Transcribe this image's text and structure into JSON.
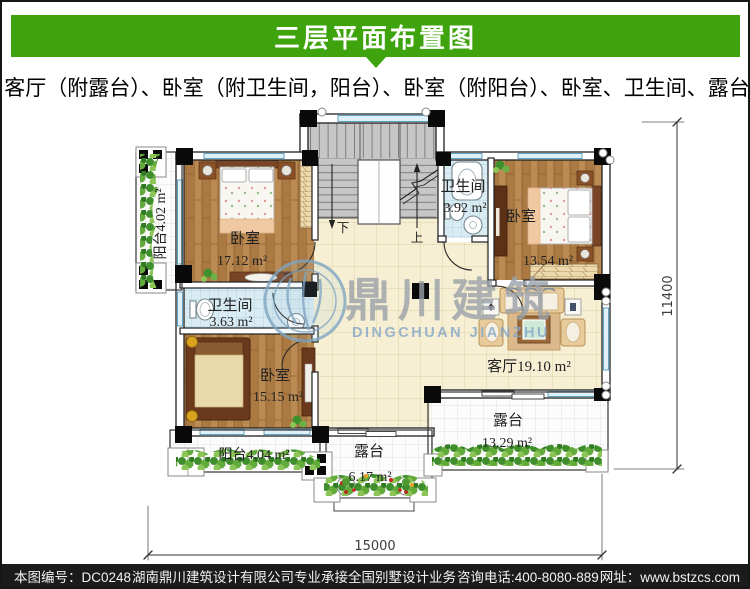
{
  "header": {
    "title": "三层平面布置图",
    "bg_color": "#3ea30d",
    "text_color": "#ffffff"
  },
  "subtitle": "客厅（附露台）、卧室（附卫生间，阳台）、卧室（附阳台）、卧室、卫生间、露台",
  "plan": {
    "rooms": {
      "bedroom_top_left": {
        "name": "卧室",
        "area": "17.12 m²"
      },
      "bathroom_left": {
        "name": "卫生间",
        "area": "3.63 m²"
      },
      "bedroom_bottom_left": {
        "name": "卧室",
        "area": "15.15 m²"
      },
      "bedroom_top_right": {
        "name": "卧室",
        "area": "13.54 m²"
      },
      "bathroom_right": {
        "name": "卫生间",
        "area": "3.92 m²"
      },
      "living_room": {
        "label": "客厅19.10 m²"
      },
      "balcony_left": {
        "label": "阳台4.02 m²"
      },
      "balcony_bottom": {
        "label": "阳台4.04 m²"
      },
      "terrace_bottom": {
        "name": "露台",
        "area": "6.17 m²"
      },
      "terrace_right": {
        "name": "露台",
        "area": "13.29 m²"
      }
    },
    "stairs": {
      "down": "下",
      "up": "上"
    },
    "dimensions": {
      "bottom": "15000",
      "right": "11400"
    }
  },
  "watermark": {
    "cn": "鼎川建筑",
    "en": "DINGCHUAN JIANZHU"
  },
  "footer": {
    "bg_color": "#1b1b1b",
    "plan_no": "本图编号：DC0248",
    "company": "湖南鼎川建筑设计有限公司专业承接全国别墅设计业务",
    "phone": "咨询电话:400-8080-889",
    "website": "网址：www.bstzcs.com"
  }
}
